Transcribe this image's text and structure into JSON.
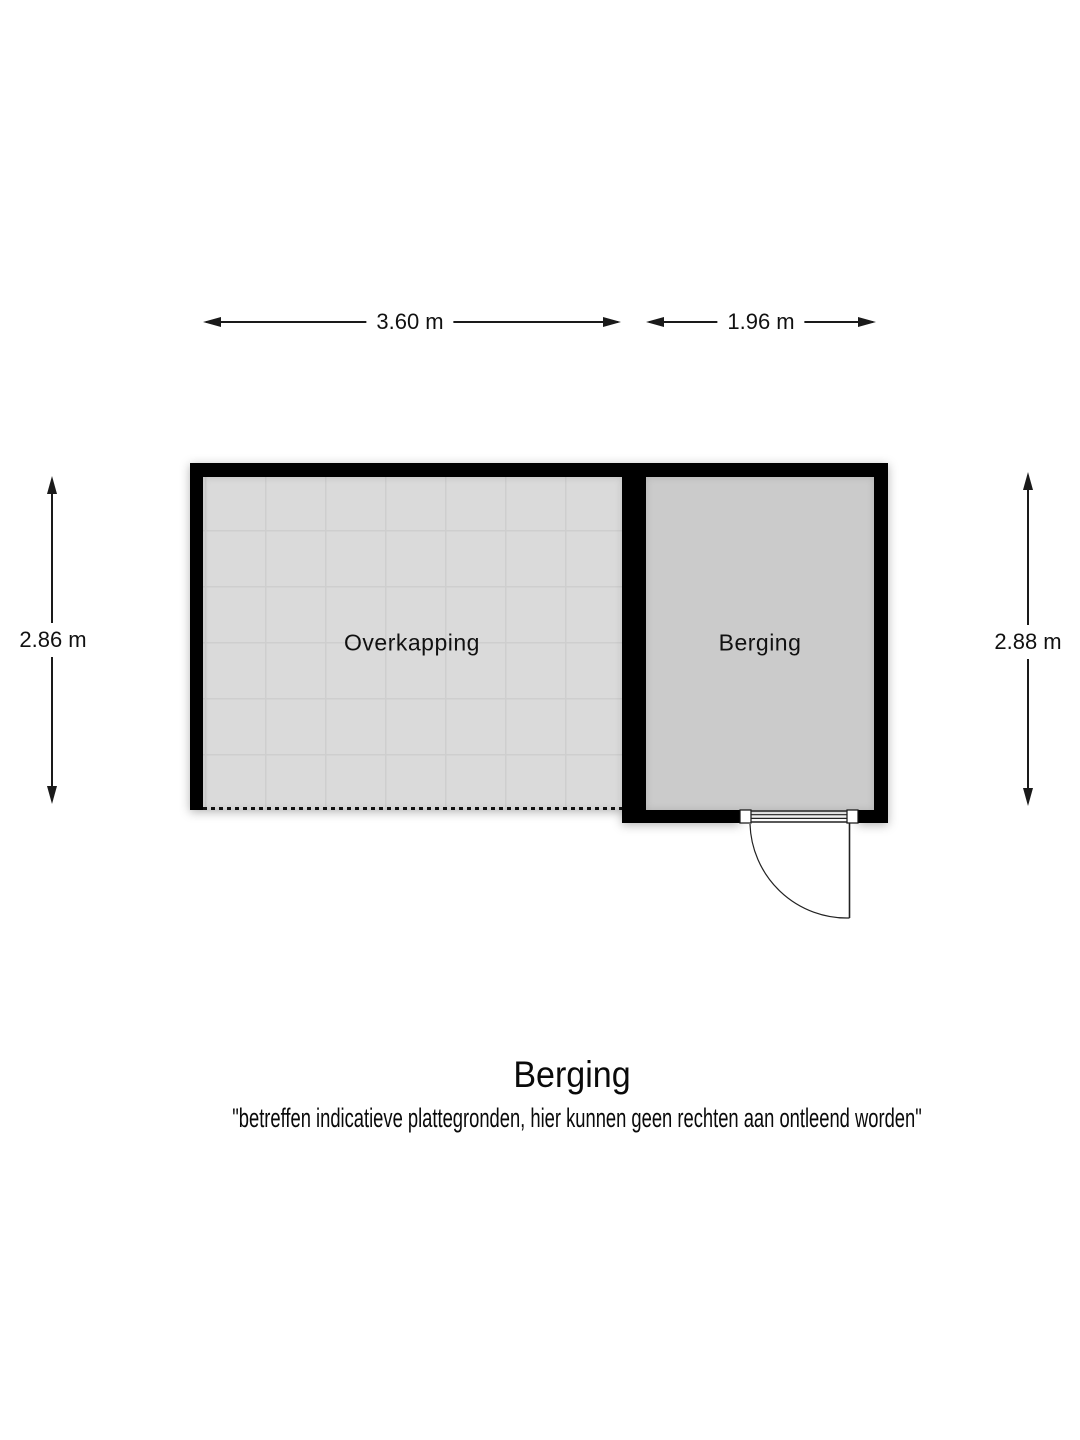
{
  "page": {
    "title": "Berging",
    "disclaimer": "\"betreffen indicatieve plattegronden, hier kunnen geen rechten aan ontleend worden\""
  },
  "dimensions": {
    "overkapping_width": "3.60 m",
    "berging_width": "1.96 m",
    "overkapping_height": "2.86 m",
    "berging_height": "2.88 m"
  },
  "rooms": {
    "overkapping": "Overkapping",
    "berging": "Berging"
  },
  "colors": {
    "wall": "#000000",
    "overkapping_floor": "#dadada",
    "berging_floor": "#cbcbcb",
    "background": "#ffffff"
  }
}
